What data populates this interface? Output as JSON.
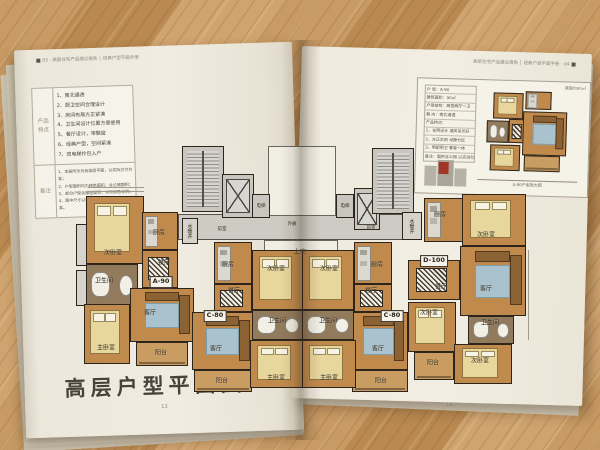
{
  "left_page": {
    "header": "03 · 高层住宅产品建议报告 │ 经典户型平面手册",
    "product_table": {
      "section1_label": "产品特点",
      "features": [
        "1、南北通透",
        "2、厨卫空间合理设计",
        "3、房间布局方正紧凑",
        "4、卫生间设计位置方便使用",
        "5、餐厅设计，带飘窗",
        "6、经典户型，空间紧凑",
        "7、双电梯拎包入户"
      ],
      "section2_label": "备注",
      "notes": [
        "1、本册所示为标准层平面，以实际交付为准；",
        "2、户型面积均为建筑面积，含公摊面积；",
        "3、部分户型含赠送面积，详见销售说明；",
        "4、图中尺寸以毫米计，最终以施工图为准。"
      ]
    },
    "title": "高层户型平面图",
    "page_number": "13"
  },
  "right_page": {
    "header": "高层住宅产品建议报告 │ 经典户型平面手册 · 04",
    "page_number": "14",
    "inset": {
      "corner_label": "建面约90㎡",
      "table_rows": [
        "户 型：A-90",
        "建筑面积：90㎡",
        "户型结构：两室两厅一卫",
        "朝 向：南北通透",
        "产品特点：",
        "1、全明设计 通风采光好",
        "2、方正实用 动静分区",
        "3、明厨明卫 餐客一体",
        "备注：面积含公摊 以实测为准"
      ],
      "caption": "A-90户型放大图"
    }
  },
  "floor_plan": {
    "unit_boxes": [
      {
        "x": 161,
        "y": 282,
        "t": "A-90"
      },
      {
        "x": 215,
        "y": 316,
        "t": "C-80"
      },
      {
        "x": 392,
        "y": 316,
        "t": "C-80"
      },
      {
        "x": 434,
        "y": 261,
        "t": "D-100"
      }
    ],
    "labels": [
      {
        "x": 113,
        "y": 252,
        "t": "次卧室"
      },
      {
        "x": 159,
        "y": 232,
        "t": "厨房"
      },
      {
        "x": 164,
        "y": 262,
        "t": "餐厅"
      },
      {
        "x": 104,
        "y": 280,
        "t": "卫生间"
      },
      {
        "x": 150,
        "y": 312,
        "t": "客厅"
      },
      {
        "x": 106,
        "y": 347,
        "t": "主卧室"
      },
      {
        "x": 161,
        "y": 352,
        "t": "阳台"
      },
      {
        "x": 228,
        "y": 264,
        "t": "厨房"
      },
      {
        "x": 234,
        "y": 290,
        "t": "餐厅"
      },
      {
        "x": 216,
        "y": 348,
        "t": "客厅"
      },
      {
        "x": 222,
        "y": 380,
        "t": "阳台"
      },
      {
        "x": 276,
        "y": 268,
        "t": "次卧室"
      },
      {
        "x": 277,
        "y": 320,
        "t": "卫生间"
      },
      {
        "x": 276,
        "y": 377,
        "t": "主卧室"
      },
      {
        "x": 377,
        "y": 264,
        "t": "厨房"
      },
      {
        "x": 371,
        "y": 290,
        "t": "餐厅"
      },
      {
        "x": 378,
        "y": 348,
        "t": "客厅"
      },
      {
        "x": 381,
        "y": 380,
        "t": "阳台"
      },
      {
        "x": 329,
        "y": 268,
        "t": "次卧室"
      },
      {
        "x": 328,
        "y": 320,
        "t": "卫生间"
      },
      {
        "x": 329,
        "y": 377,
        "t": "主卧室"
      },
      {
        "x": 440,
        "y": 214,
        "t": "厨房"
      },
      {
        "x": 486,
        "y": 234,
        "t": "次卧室"
      },
      {
        "x": 486,
        "y": 288,
        "t": "客厅"
      },
      {
        "x": 441,
        "y": 286,
        "t": "餐厅"
      },
      {
        "x": 429,
        "y": 312,
        "t": "次卧室"
      },
      {
        "x": 490,
        "y": 322,
        "t": "卫生间"
      },
      {
        "x": 480,
        "y": 360,
        "t": "次卧室"
      },
      {
        "x": 433,
        "y": 362,
        "t": "阳台"
      },
      {
        "x": 222,
        "y": 229,
        "t": "前室",
        "s": 4.5
      },
      {
        "x": 371,
        "y": 228,
        "t": "前室",
        "s": 4.5
      },
      {
        "x": 292,
        "y": 224,
        "t": "外廊",
        "s": 4.5
      },
      {
        "x": 300,
        "y": 251,
        "t": "上空"
      },
      {
        "x": 261,
        "y": 206,
        "t": "电梯",
        "s": 4.5
      },
      {
        "x": 345,
        "y": 206,
        "t": "电梯",
        "s": 4.5
      },
      {
        "x": 190,
        "y": 231,
        "t": "水暖井",
        "v": true
      },
      {
        "x": 412,
        "y": 226,
        "t": "水暖井",
        "v": true
      }
    ],
    "rooms": [
      {
        "x": 178,
        "y": 214,
        "w": 230,
        "h": 26,
        "t": "corridor",
        "n": "corridor"
      },
      {
        "x": 268,
        "y": 146,
        "w": 68,
        "h": 70,
        "t": "void",
        "n": "atrium-void"
      },
      {
        "x": 264,
        "y": 240,
        "w": 74,
        "h": 24,
        "t": "void",
        "n": "open-above"
      },
      {
        "x": 182,
        "y": 146,
        "w": 42,
        "h": 66,
        "t": "core",
        "f": "stairs",
        "n": "stairwell-left"
      },
      {
        "x": 222,
        "y": 174,
        "w": 32,
        "h": 44,
        "t": "core",
        "f": "elevx",
        "n": "elevator-left"
      },
      {
        "x": 252,
        "y": 194,
        "w": 18,
        "h": 24,
        "t": "core",
        "n": "elevator-small-left"
      },
      {
        "x": 336,
        "y": 194,
        "w": 18,
        "h": 24,
        "t": "core",
        "n": "elevator-small-right"
      },
      {
        "x": 354,
        "y": 188,
        "w": 26,
        "h": 42,
        "t": "core",
        "f": "elevx",
        "n": "elevator-right"
      },
      {
        "x": 372,
        "y": 148,
        "w": 42,
        "h": 66,
        "t": "core",
        "f": "stairs",
        "n": "stairwell-right"
      },
      {
        "x": 182,
        "y": 218,
        "w": 16,
        "h": 26,
        "t": "shaft",
        "n": "shaft-left"
      },
      {
        "x": 402,
        "y": 212,
        "w": 20,
        "h": 28,
        "t": "shaft",
        "n": "shaft-right"
      },
      {
        "x": 76,
        "y": 224,
        "w": 12,
        "h": 42,
        "t": "shaft",
        "n": "edge-shaft-1"
      },
      {
        "x": 76,
        "y": 270,
        "w": 12,
        "h": 36,
        "t": "shaft",
        "n": "edge-shaft-2"
      },
      {
        "x": 86,
        "y": 196,
        "w": 58,
        "h": 68,
        "t": "room",
        "f": "bed",
        "n": "a90-bedroom-2"
      },
      {
        "x": 142,
        "y": 212,
        "w": 36,
        "h": 38,
        "t": "room",
        "f": "kitchen",
        "n": "a90-kitchen"
      },
      {
        "x": 142,
        "y": 250,
        "w": 36,
        "h": 38,
        "t": "room",
        "f": "table",
        "n": "a90-dining"
      },
      {
        "x": 86,
        "y": 264,
        "w": 52,
        "h": 42,
        "t": "bath",
        "f": "bathfix",
        "n": "a90-bath"
      },
      {
        "x": 130,
        "y": 288,
        "w": 64,
        "h": 54,
        "t": "room",
        "f": "sofa",
        "n": "a90-living"
      },
      {
        "x": 84,
        "y": 304,
        "w": 46,
        "h": 60,
        "t": "room",
        "f": "bed",
        "n": "a90-master"
      },
      {
        "x": 136,
        "y": 342,
        "w": 52,
        "h": 24,
        "t": "balcony",
        "n": "a90-balcony"
      },
      {
        "x": 214,
        "y": 242,
        "w": 38,
        "h": 42,
        "t": "room",
        "f": "kitchen",
        "n": "c80l-kitchen"
      },
      {
        "x": 214,
        "y": 284,
        "w": 38,
        "h": 28,
        "t": "room",
        "f": "table",
        "n": "c80l-dining"
      },
      {
        "x": 192,
        "y": 312,
        "w": 62,
        "h": 58,
        "t": "room",
        "f": "sofa",
        "n": "c80l-living"
      },
      {
        "x": 194,
        "y": 370,
        "w": 58,
        "h": 22,
        "t": "balcony",
        "n": "c80l-balcony"
      },
      {
        "x": 252,
        "y": 250,
        "w": 52,
        "h": 60,
        "t": "room",
        "f": "bed",
        "n": "c80l-bedroom"
      },
      {
        "x": 252,
        "y": 310,
        "w": 52,
        "h": 30,
        "t": "bath",
        "f": "bathfix",
        "n": "c80l-bath"
      },
      {
        "x": 250,
        "y": 340,
        "w": 54,
        "h": 48,
        "t": "room",
        "f": "bed",
        "n": "c80l-master"
      },
      {
        "x": 354,
        "y": 242,
        "w": 38,
        "h": 42,
        "t": "room",
        "f": "kitchen",
        "n": "c80r-kitchen"
      },
      {
        "x": 354,
        "y": 284,
        "w": 38,
        "h": 28,
        "t": "room",
        "f": "table",
        "n": "c80r-dining"
      },
      {
        "x": 350,
        "y": 312,
        "w": 58,
        "h": 58,
        "t": "room",
        "f": "sofa",
        "n": "c80r-living"
      },
      {
        "x": 352,
        "y": 370,
        "w": 56,
        "h": 22,
        "t": "balcony",
        "n": "c80r-balcony"
      },
      {
        "x": 302,
        "y": 250,
        "w": 52,
        "h": 60,
        "t": "room",
        "f": "bed",
        "n": "c80r-bedroom"
      },
      {
        "x": 302,
        "y": 310,
        "w": 52,
        "h": 30,
        "t": "bath",
        "f": "bathfix",
        "n": "c80r-bath"
      },
      {
        "x": 302,
        "y": 340,
        "w": 54,
        "h": 48,
        "t": "room",
        "f": "bed",
        "n": "c80r-master"
      },
      {
        "x": 424,
        "y": 198,
        "w": 40,
        "h": 44,
        "t": "room",
        "f": "kitchen",
        "n": "d100-kitchen"
      },
      {
        "x": 462,
        "y": 194,
        "w": 64,
        "h": 52,
        "t": "room",
        "f": "bed",
        "n": "d100-bedroom-top"
      },
      {
        "x": 460,
        "y": 246,
        "w": 66,
        "h": 70,
        "t": "room",
        "f": "sofa",
        "n": "d100-living"
      },
      {
        "x": 408,
        "y": 260,
        "w": 52,
        "h": 40,
        "t": "room",
        "f": "table",
        "n": "d100-dining"
      },
      {
        "x": 408,
        "y": 302,
        "w": 48,
        "h": 50,
        "t": "room",
        "f": "bed",
        "n": "d100-bedroom-mid"
      },
      {
        "x": 468,
        "y": 316,
        "w": 46,
        "h": 28,
        "t": "bath",
        "f": "bathfix",
        "n": "d100-bath"
      },
      {
        "x": 454,
        "y": 344,
        "w": 58,
        "h": 40,
        "t": "room",
        "f": "bed",
        "n": "d100-bedroom-bottom"
      },
      {
        "x": 414,
        "y": 352,
        "w": 40,
        "h": 28,
        "t": "balcony",
        "n": "d100-balcony"
      }
    ],
    "inset_rooms": [
      {
        "x": 14,
        "y": 4,
        "w": 30,
        "h": 26,
        "t": "room",
        "f": "bed",
        "n": "inset-bedroom-1"
      },
      {
        "x": 46,
        "y": 2,
        "w": 26,
        "h": 18,
        "t": "room",
        "f": "kitchen",
        "n": "inset-kitchen"
      },
      {
        "x": 8,
        "y": 32,
        "w": 22,
        "h": 22,
        "t": "bath",
        "f": "bathfix",
        "n": "inset-bath"
      },
      {
        "x": 30,
        "y": 30,
        "w": 16,
        "h": 24,
        "t": "room",
        "f": "table",
        "n": "inset-dining"
      },
      {
        "x": 44,
        "y": 22,
        "w": 44,
        "h": 44,
        "t": "room",
        "f": "sofa",
        "n": "inset-living"
      },
      {
        "x": 12,
        "y": 56,
        "w": 30,
        "h": 26,
        "t": "room",
        "f": "bed",
        "n": "inset-bedroom-2"
      },
      {
        "x": 46,
        "y": 66,
        "w": 36,
        "h": 16,
        "t": "balcony",
        "n": "inset-balcony"
      }
    ]
  },
  "colors": {
    "wall": "#2d241b",
    "room_fill": "#c08a4d",
    "core_fill": "#c9c6c0",
    "paper": "#f0ece1",
    "wood": "#c89a64",
    "highlight_red": "#a23526"
  }
}
